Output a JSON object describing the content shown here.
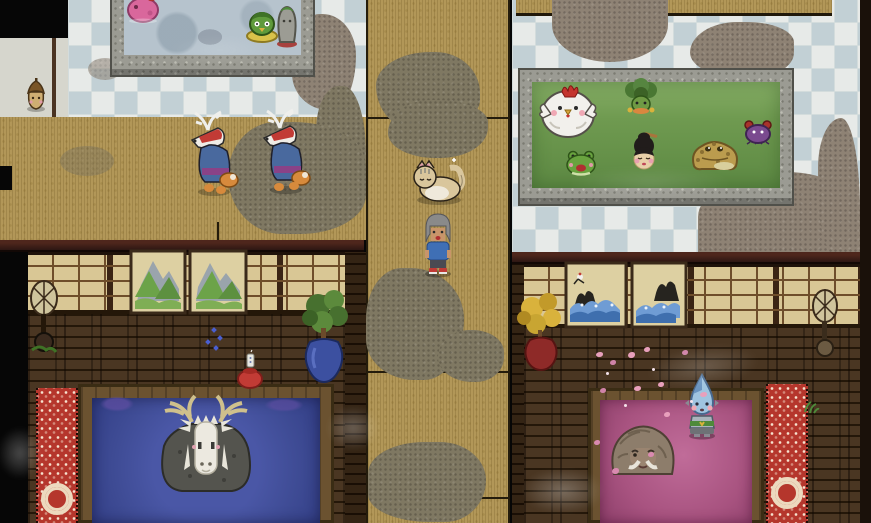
{
  "scene": {
    "title": "Spirit bathhouse - overhead view",
    "type": "pixel-art top-down game scene",
    "visible_text": []
  },
  "palette": {
    "voidBlack": "#060606",
    "edgeBand": "#1a110a",
    "tileA": "#e7eae8",
    "tileB": "#c2d0d5",
    "grout": "#d3dcdc",
    "stone": "#9b9b93",
    "tatami": "#b29758",
    "woodFloor": "#3f2d1c",
    "woodLine": "#241709",
    "beamDark": "#2d1713",
    "shoji": "#d9c795",
    "shojiGrid": "#6f4e2b",
    "waterGray": "#b6c3cd",
    "waterGreen": "#6f9a50",
    "waterBlue": "#424f9c",
    "waterPink": "#aa5483",
    "poolWood": "#6b5230",
    "rugRed": "#b5362c",
    "grimeTile": "#8e8274",
    "grimeTatami": "#7f7862",
    "steamWhite": "rgba(255,255,255,0.28)",
    "concrete": "#d6d6cd"
  },
  "areas": {
    "tiled_floor_left": {
      "label": "checkered tile bathing floor, upper left"
    },
    "tiled_floor_right": {
      "label": "checkered tile bathing floor, upper right"
    },
    "tatami_hall": {
      "label": "tatami hall where fox spirits walk"
    },
    "corridor": {
      "label": "central tatami corridor"
    },
    "tatami_ledge": {
      "label": "tatami ledge, top right"
    },
    "entry_strip": {
      "label": "light concrete entry strip, left edge"
    },
    "room_left": {
      "label": "dark wooden room, lower left"
    },
    "room_right": {
      "label": "dark wooden room, lower right"
    },
    "grey_bath": {
      "label": "grey stone bath, top left"
    },
    "green_bath": {
      "label": "green herbal bath, top right"
    },
    "blue_bath": {
      "label": "deep blue bath, lower left"
    },
    "pink_bath": {
      "label": "pink blossom bath, lower right"
    }
  },
  "entities": {
    "player": {
      "label": "player character with grey hair and blue shirt"
    },
    "cat": {
      "label": "cream cat lying on the corridor"
    },
    "fox_spirit_a": {
      "label": "antlered fox spirit in blue robe"
    },
    "fox_spirit_b": {
      "label": "antlered fox spirit in blue robe"
    },
    "pink_spirit": {
      "label": "pink blob spirit soaking in grey bath"
    },
    "kappa_spirit": {
      "label": "green kappa spirit on yellow float ring"
    },
    "moss_stone_spirit": {
      "label": "mossy stone spirit in grey bath"
    },
    "seed_spirit": {
      "label": "small acorn seed spirit on entry strip"
    },
    "chicken_spirit": {
      "label": "large white chicken spirit in green bath"
    },
    "leaf_spirit": {
      "label": "leaf-haired spirit in green bath"
    },
    "frog_spirit": {
      "label": "small green frog in green bath"
    },
    "geisha_spirit": {
      "label": "black-haired lady spirit in green bath"
    },
    "toad_spirit": {
      "label": "large brown toad in green bath"
    },
    "crab_spirit": {
      "label": "purple crab spirit at edge of green bath"
    },
    "deer_spirit": {
      "label": "great antlered deer spirit in blue bath"
    },
    "boulder_ape_spirit": {
      "label": "mustached boulder ape spirit in pink bath"
    },
    "droplet_spirit": {
      "label": "blue droplet spirit standing at pink bath edge"
    }
  },
  "props": {
    "paper_lamp_left": {
      "label": "standing paper lamp, left room"
    },
    "paper_lamp_right": {
      "label": "standing paper lamp, right room"
    },
    "potted_tree": {
      "label": "green tree in blue pot"
    },
    "golden_tree": {
      "label": "golden tree in red pot"
    },
    "sake_jar": {
      "label": "red sake jar with white bottle"
    },
    "rug_left": {
      "label": "red patterned runner rug, left room"
    },
    "rug_right": {
      "label": "red patterned runner rug, right room"
    },
    "mountain_painting_left": {
      "label": "mountain landscape screen painting"
    },
    "mountain_painting_right": {
      "label": "mountain landscape screen painting"
    },
    "wave_painting_left": {
      "label": "wave and crane screen painting"
    },
    "wave_painting_right": {
      "label": "wave screen painting"
    },
    "grass_sprig": {
      "label": "small grass sprig"
    },
    "blue_sparkles": {
      "label": "blue sparkles on floor"
    },
    "pink_petals": {
      "label": "scattered pink petals"
    },
    "drain": {
      "label": "bath drain"
    }
  }
}
